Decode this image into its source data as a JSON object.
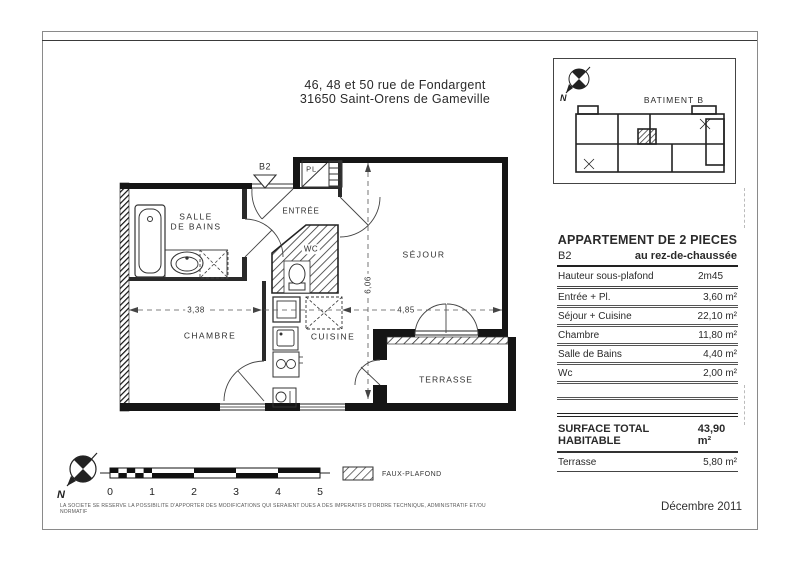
{
  "title": {
    "line1": "46, 48 et 50 rue de Fondargent",
    "line2": "31650 Saint-Orens de Gameville"
  },
  "key_plan": {
    "label": "BATIMENT B"
  },
  "plan": {
    "unit_marker": "B2",
    "rooms": {
      "salle_de_bains": "SALLE\nDE BAINS",
      "entree": "ENTRÉE",
      "placard": "PL.",
      "wc": "WC",
      "sejour": "SÉJOUR",
      "chambre": "CHAMBRE",
      "cuisine": "CUISINE",
      "terrasse": "TERRASSE"
    },
    "dimensions": {
      "chambre_width": "3,38",
      "sejour_width": "4,85",
      "depth": "6,06"
    }
  },
  "legend": {
    "faux_plafond": "FAUX-PLAFOND"
  },
  "scale_bar": {
    "ticks": [
      "0",
      "1",
      "2",
      "3",
      "4",
      "5"
    ]
  },
  "info_table": {
    "title": "APPARTEMENT DE 2 PIECES",
    "unit": "B2",
    "floor": "au rez-de-chaussée",
    "height_label": "Hauteur sous-plafond",
    "height_value": "2m45",
    "rows": [
      {
        "label": "Entrée + Pl.",
        "value": "3,60  m²"
      },
      {
        "label": "Séjour + Cuisine",
        "value": "22,10  m²"
      },
      {
        "label": "Chambre",
        "value": "11,80  m²"
      },
      {
        "label": "Salle de Bains",
        "value": "4,40  m²"
      },
      {
        "label": "Wc",
        "value": "2,00  m²"
      }
    ],
    "total_label": "SURFACE TOTAL HABITABLE",
    "total_value": "43,90 m²",
    "terrace_label": "Terrasse",
    "terrace_value": "5,80  m²"
  },
  "footer": {
    "disclaimer": "LA SOCIETE SE RESERVE LA POSSIBILITE D'APPORTER DES MODIFICATIONS QUI SERAIENT DUES A DES IMPERATIFS D'ORDRE TECHNIQUE, ADMINISTRATIF ET/OU NORMATIF",
    "date": "Décembre 2011"
  }
}
